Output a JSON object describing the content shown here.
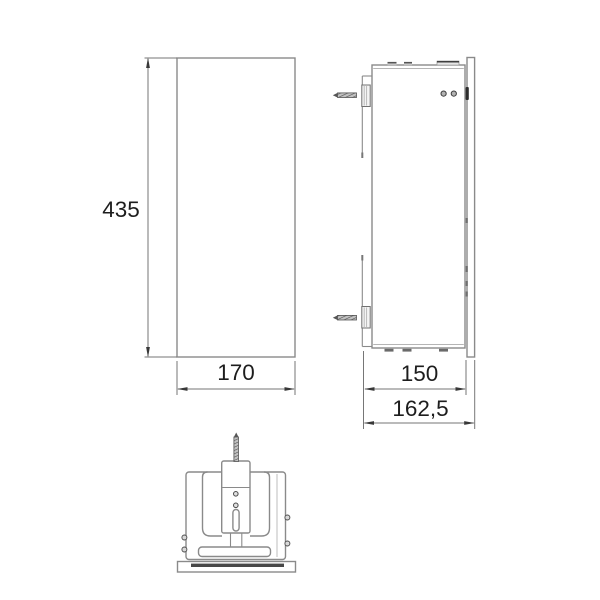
{
  "drawing": {
    "kind": "technical-dimension-drawing",
    "front_view": {
      "height_label": "435",
      "width_label": "170"
    },
    "side_view": {
      "depth_label": "150",
      "overall_depth_label": "162,5"
    }
  },
  "colors": {
    "background": "#ffffff",
    "line": "#8a8a8a",
    "dark": "#3f3f3f",
    "text": "#1d1d1d"
  }
}
